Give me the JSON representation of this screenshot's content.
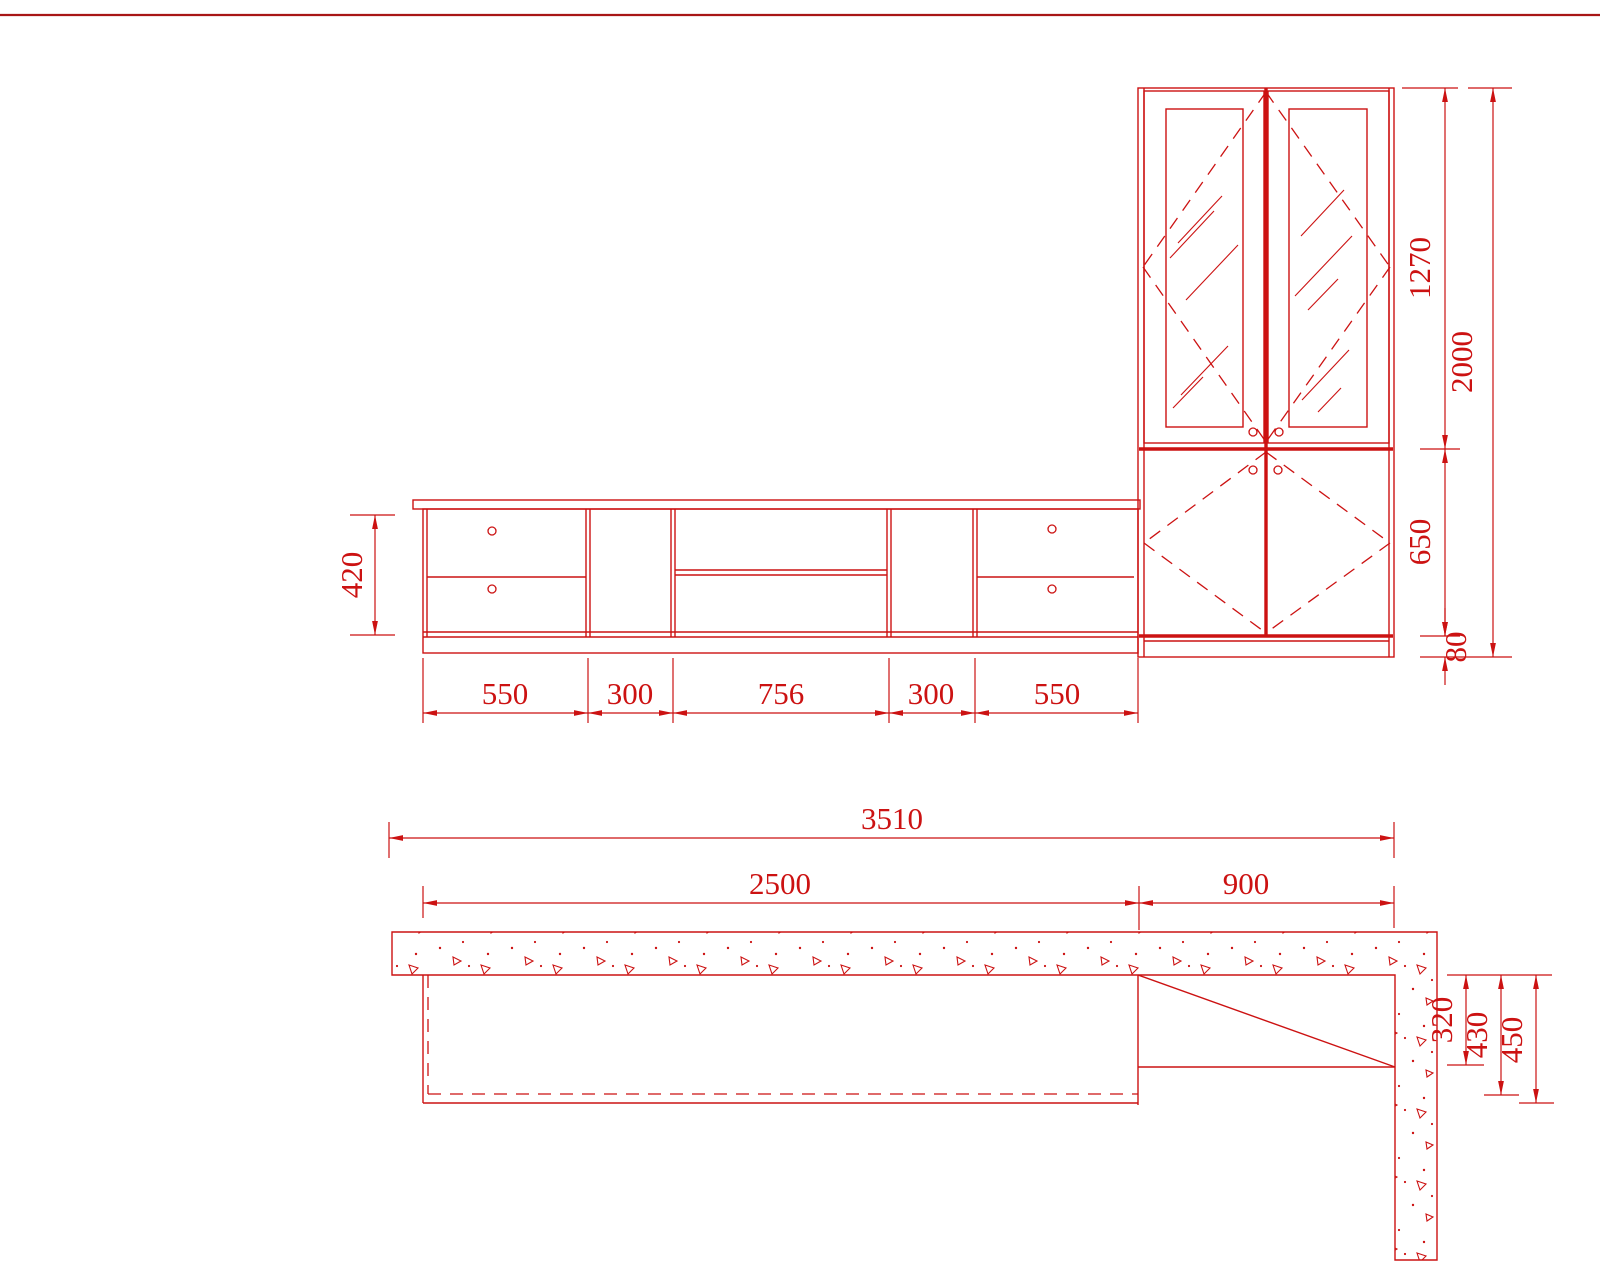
{
  "drawing": {
    "kind": "furniture-cad-drawing",
    "line_color": "#cc1212",
    "border_color": "#a81616",
    "background": "#ffffff",
    "elevation": {
      "height_dim": "420",
      "width_dims": [
        "550",
        "300",
        "756",
        "300",
        "550"
      ],
      "upper_door_dim": "1270",
      "lower_door_dim": "650",
      "plinth_dim": "80",
      "total_height_dim": "2000"
    },
    "plan": {
      "total_width_dim": "3510",
      "cabinet_width_dim": "2500",
      "tall_cabinet_width_dim": "900",
      "niche_depth_dim": "320",
      "inner_depth_dim": "430",
      "outer_depth_dim": "450"
    }
  }
}
